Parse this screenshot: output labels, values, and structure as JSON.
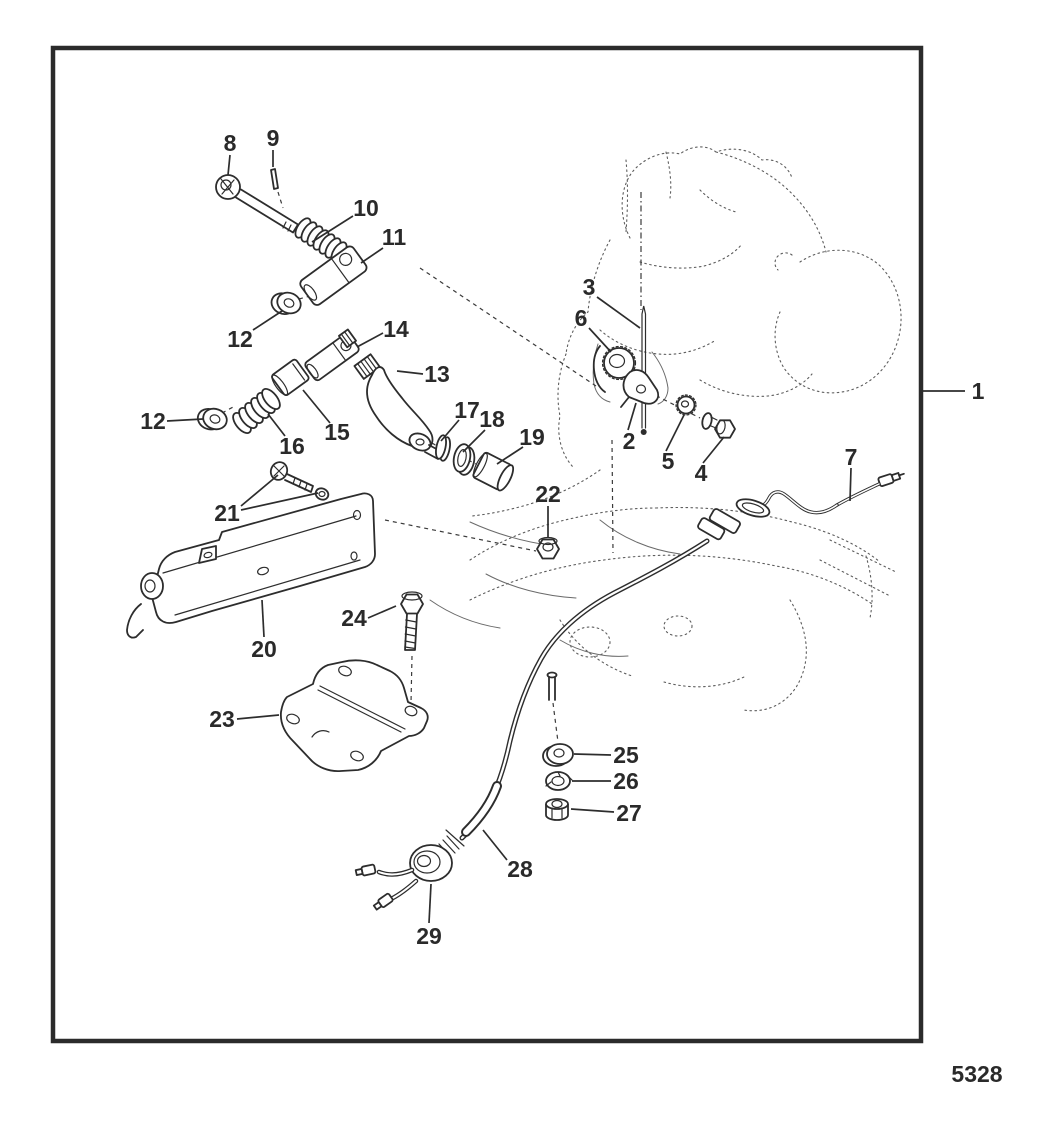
{
  "figure_number": "5328",
  "colors": {
    "line": "#2d2d2d",
    "sketch": "#5d5d5d",
    "label": "#2a2a2a",
    "background": "#ffffff"
  },
  "callouts": [
    {
      "label": "1",
      "x": 978,
      "y": 391,
      "leaders": [
        [
          [
            965,
            391
          ],
          [
            922,
            391
          ]
        ]
      ]
    },
    {
      "label": "2",
      "x": 629,
      "y": 441,
      "leaders": [
        [
          [
            628,
            430
          ],
          [
            636,
            403
          ]
        ]
      ]
    },
    {
      "label": "3",
      "x": 589,
      "y": 287,
      "leaders": [
        [
          [
            597,
            297
          ],
          [
            640,
            328
          ]
        ]
      ]
    },
    {
      "label": "4",
      "x": 701,
      "y": 473,
      "leaders": [
        [
          [
            703,
            463
          ],
          [
            724,
            437
          ]
        ]
      ]
    },
    {
      "label": "5",
      "x": 668,
      "y": 461,
      "leaders": [
        [
          [
            666,
            451
          ],
          [
            684,
            415
          ]
        ]
      ]
    },
    {
      "label": "6",
      "x": 581,
      "y": 318,
      "leaders": [
        [
          [
            589,
            328
          ],
          [
            611,
            352
          ]
        ]
      ]
    },
    {
      "label": "7",
      "x": 851,
      "y": 457,
      "leaders": [
        [
          [
            851,
            468
          ],
          [
            850,
            501
          ]
        ]
      ]
    },
    {
      "label": "8",
      "x": 230,
      "y": 143,
      "leaders": [
        [
          [
            230,
            155
          ],
          [
            228,
            175
          ]
        ]
      ]
    },
    {
      "label": "9",
      "x": 273,
      "y": 138,
      "leaders": [
        [
          [
            273,
            150
          ],
          [
            273,
            167
          ]
        ]
      ]
    },
    {
      "label": "10",
      "x": 366,
      "y": 208,
      "leaders": [
        [
          [
            353,
            216
          ],
          [
            312,
            242
          ]
        ]
      ]
    },
    {
      "label": "11",
      "x": 394,
      "y": 237,
      "leaders": [
        [
          [
            383,
            248
          ],
          [
            361,
            263
          ]
        ]
      ]
    },
    {
      "label": "12",
      "x": 240,
      "y": 339,
      "leaders": [
        [
          [
            253,
            330
          ],
          [
            282,
            311
          ]
        ]
      ]
    },
    {
      "label": "13",
      "x": 437,
      "y": 374,
      "leaders": [
        [
          [
            423,
            374
          ],
          [
            397,
            371
          ]
        ]
      ]
    },
    {
      "label": "14",
      "x": 396,
      "y": 329,
      "leaders": [
        [
          [
            383,
            333
          ],
          [
            357,
            347
          ]
        ]
      ]
    },
    {
      "label": "15",
      "x": 337,
      "y": 432,
      "leaders": [
        [
          [
            330,
            423
          ],
          [
            303,
            390
          ]
        ]
      ]
    },
    {
      "label": "16",
      "x": 292,
      "y": 446,
      "leaders": [
        [
          [
            285,
            436
          ],
          [
            268,
            414
          ]
        ]
      ]
    },
    {
      "label": "12",
      "x": 153,
      "y": 421,
      "leaders": [
        [
          [
            167,
            421
          ],
          [
            203,
            419
          ]
        ]
      ]
    },
    {
      "label": "17",
      "x": 467,
      "y": 410,
      "leaders": [
        [
          [
            459,
            420
          ],
          [
            441,
            441
          ]
        ]
      ]
    },
    {
      "label": "18",
      "x": 492,
      "y": 419,
      "leaders": [
        [
          [
            485,
            430
          ],
          [
            463,
            452
          ]
        ]
      ]
    },
    {
      "label": "19",
      "x": 532,
      "y": 437,
      "leaders": [
        [
          [
            523,
            447
          ],
          [
            497,
            464
          ]
        ]
      ]
    },
    {
      "label": "20",
      "x": 264,
      "y": 649,
      "leaders": [
        [
          [
            264,
            637
          ],
          [
            262,
            600
          ]
        ]
      ]
    },
    {
      "label": "21",
      "x": 227,
      "y": 513,
      "leaders": [
        [
          [
            241,
            506
          ],
          [
            278,
            475
          ]
        ],
        [
          [
            241,
            510
          ],
          [
            318,
            493
          ]
        ]
      ]
    },
    {
      "label": "22",
      "x": 548,
      "y": 494,
      "leaders": [
        [
          [
            548,
            506
          ],
          [
            548,
            538
          ]
        ]
      ]
    },
    {
      "label": "23",
      "x": 222,
      "y": 719,
      "leaders": [
        [
          [
            237,
            719
          ],
          [
            279,
            715
          ]
        ]
      ]
    },
    {
      "label": "24",
      "x": 354,
      "y": 618,
      "leaders": [
        [
          [
            368,
            618
          ],
          [
            396,
            606
          ]
        ]
      ]
    },
    {
      "label": "25",
      "x": 626,
      "y": 755,
      "leaders": [
        [
          [
            611,
            755
          ],
          [
            574,
            754
          ]
        ]
      ]
    },
    {
      "label": "26",
      "x": 626,
      "y": 781,
      "leaders": [
        [
          [
            611,
            781
          ],
          [
            572,
            781
          ]
        ]
      ]
    },
    {
      "label": "27",
      "x": 629,
      "y": 813,
      "leaders": [
        [
          [
            614,
            812
          ],
          [
            571,
            809
          ]
        ]
      ]
    },
    {
      "label": "28",
      "x": 520,
      "y": 869,
      "leaders": [
        [
          [
            507,
            860
          ],
          [
            483,
            830
          ]
        ]
      ]
    },
    {
      "label": "29",
      "x": 429,
      "y": 936,
      "leaders": [
        [
          [
            429,
            923
          ],
          [
            431,
            884
          ]
        ]
      ]
    }
  ]
}
